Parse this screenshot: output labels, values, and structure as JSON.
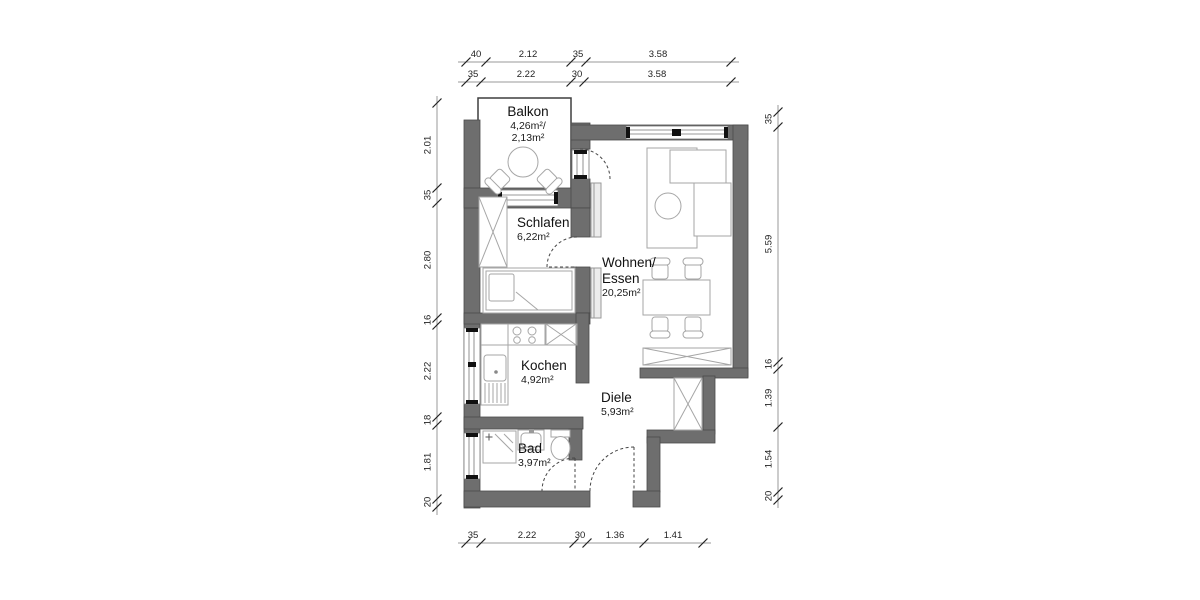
{
  "drawing_type": "apartment-floor-plan",
  "rooms": {
    "balkon": {
      "name": "Balkon",
      "area_line1": "4,26m²/",
      "area_line2": "2,13m²"
    },
    "schlafen": {
      "name": "Schlafen",
      "area": "6,22m²"
    },
    "wohnen": {
      "name_line1": "Wohnen/",
      "name_line2": "Essen",
      "area": "20,25m²"
    },
    "kochen": {
      "name": "Kochen",
      "area": "4,92m²"
    },
    "diele": {
      "name": "Diele",
      "area": "5,93m²"
    },
    "bad": {
      "name": "Bad",
      "area": "3,97m²"
    }
  },
  "dimensions": {
    "top_row1": [
      "40",
      "2.12",
      "35",
      "3.58"
    ],
    "top_row2": [
      "35",
      "2.22",
      "30",
      "3.58"
    ],
    "left_column": [
      "2.01",
      "35",
      "2.80",
      "16",
      "2.22",
      "18",
      "1.81",
      "20"
    ],
    "right_column": [
      "35",
      "5.59",
      "16",
      "1.39",
      "1.54",
      "20"
    ],
    "bottom_row": [
      "35",
      "2.22",
      "30",
      "1.36",
      "1.41"
    ]
  },
  "colors": {
    "wall_fill": "#6e6e6e",
    "wall_outline": "#4a4a4a",
    "background": "#ffffff",
    "furniture_stroke": "#a6a6a6",
    "dimension_line": "#9a9a9a",
    "text": "#111111"
  }
}
